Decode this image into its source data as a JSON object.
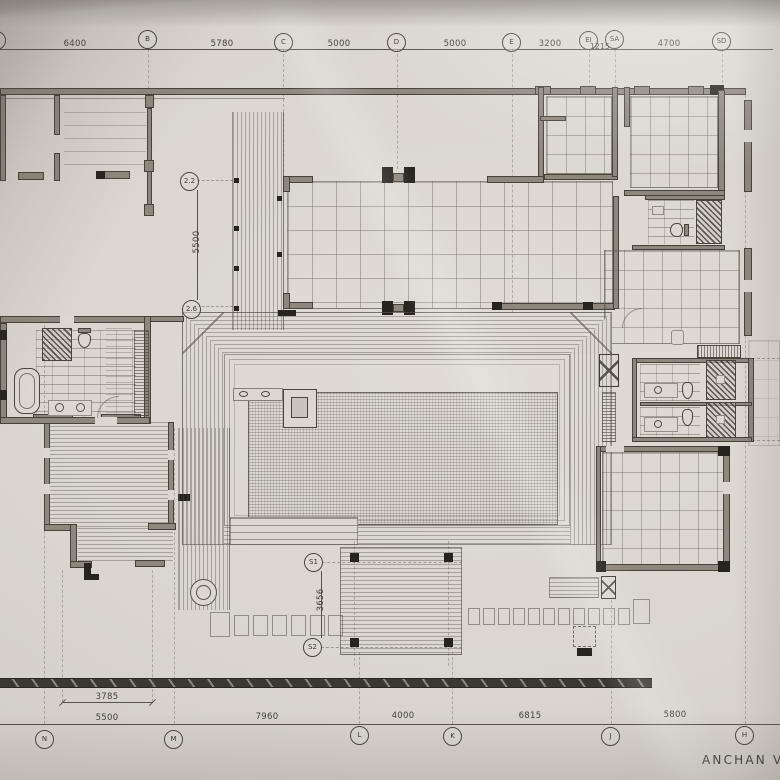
{
  "meta": {
    "sheet_title": "ANCHAN VI"
  },
  "grid_top": {
    "bubbles": [
      "B",
      "C",
      "D",
      "E",
      "EI",
      "SA",
      "SD"
    ],
    "dims": [
      "6400",
      "5780",
      "5000",
      "5000",
      "3200",
      "1215",
      "4700"
    ]
  },
  "grid_bottom": {
    "bubbles": [
      "N",
      "M",
      "L",
      "K",
      "J",
      "H"
    ],
    "dims": [
      "5500",
      "7960",
      "4000",
      "6815",
      "5800"
    ],
    "sub_dim": "3785"
  },
  "marks": {
    "level_upper": "2.2",
    "level_lower": "2.6",
    "dim_left_vertical": "5500",
    "s1": "S1",
    "s2": "S2",
    "dim_sala_vertical": "3656"
  },
  "colors": {
    "paper": "#dcd8d1",
    "ink": "#4e4944",
    "wall_fill": "#8e877e",
    "poche": "#27231e"
  }
}
